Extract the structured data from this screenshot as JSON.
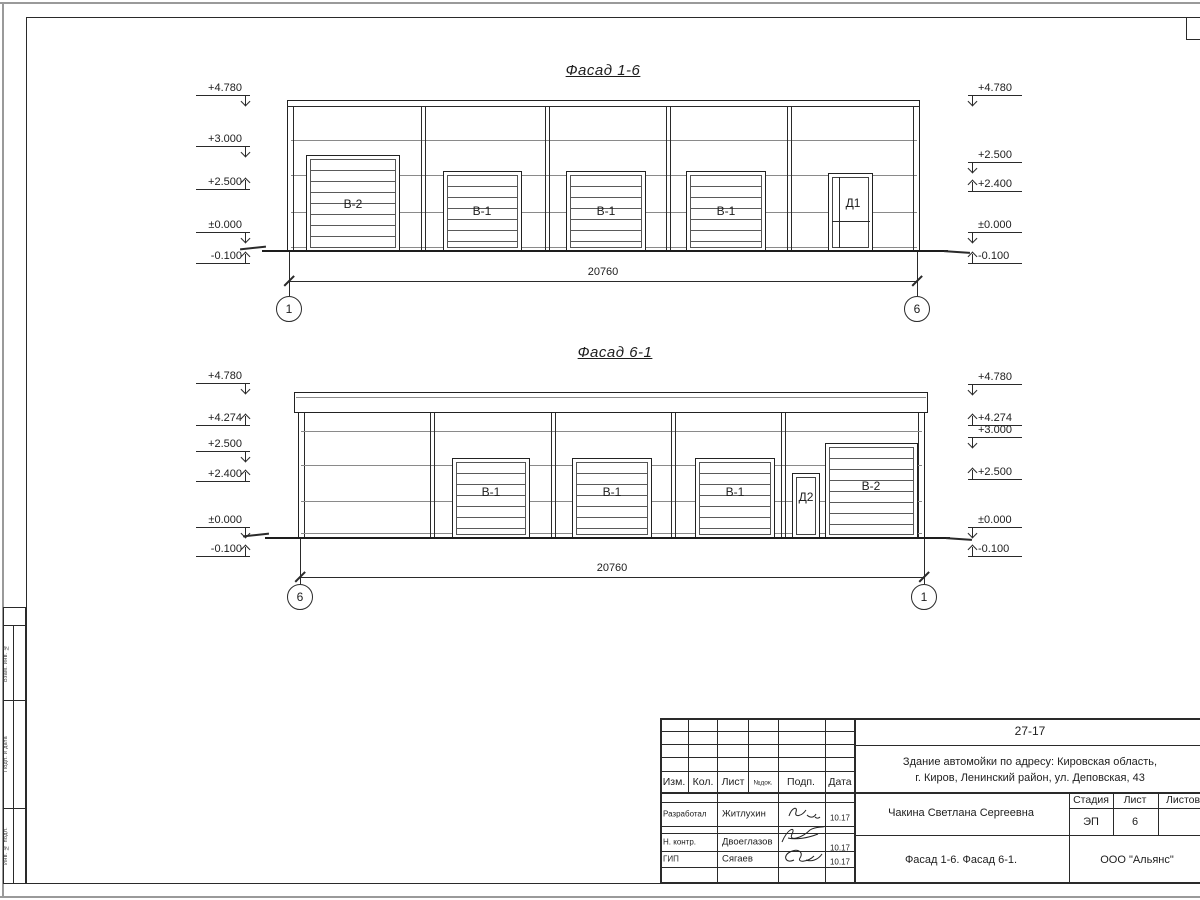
{
  "drawing": {
    "facade16": {
      "title": "Фасад 1-6",
      "left_marks": [
        "+4.780",
        "+3.000",
        "+2.500",
        "±0.000",
        "-0.100"
      ],
      "right_marks": [
        "+4.780",
        "+2.500",
        "+2.400",
        "±0.000",
        "-0.100"
      ],
      "gate_labels": [
        "В-2",
        "В-1",
        "В-1",
        "В-1"
      ],
      "door_label": "Д1",
      "dimension": "20760",
      "axis_left": "1",
      "axis_right": "6"
    },
    "facade61": {
      "title": "Фасад 6-1",
      "left_marks": [
        "+4.780",
        "+4.274",
        "+2.500",
        "+2.400",
        "±0.000",
        "-0.100"
      ],
      "right_marks": [
        "+4.780",
        "+4.274",
        "+3.000",
        "+2.500",
        "±0.000",
        "-0.100"
      ],
      "gate_labels": [
        "В-1",
        "В-1",
        "В-1",
        "В-2"
      ],
      "door_label": "Д2",
      "dimension": "20760",
      "axis_left": "6",
      "axis_right": "1"
    },
    "titleblock": {
      "doc_number": "27-17",
      "project_line1": "Здание автомойки по адресу: Кировская область,",
      "project_line2": "г. Киров, Ленинский район, ул. Деповская, 43",
      "header_cols": [
        "Изм.",
        "Кол.",
        "Лист",
        "№док.",
        "Подп.",
        "Дата"
      ],
      "rows": [
        {
          "role": "Разработал",
          "name": "Житлухин",
          "date": "10.17"
        },
        {
          "role": "Н. контр.",
          "name": "Двоеглазов",
          "date": "10.17"
        },
        {
          "role": "ГИП",
          "name": "Сягаев",
          "date": "10.17"
        }
      ],
      "client": "Чакина Светлана Сергеевна",
      "stage_label": "Стадия",
      "sheet_label": "Лист",
      "sheets_label": "Листов",
      "stage_value": "ЭП",
      "sheet_value": "6",
      "sheet_title": "Фасад 1-6. Фасад 6-1.",
      "company": "ООО \"Альянс\""
    },
    "side_strip": {
      "labels": [
        "Взам. инв. №",
        "Подп. и дата",
        "Инв. № подл."
      ]
    }
  }
}
